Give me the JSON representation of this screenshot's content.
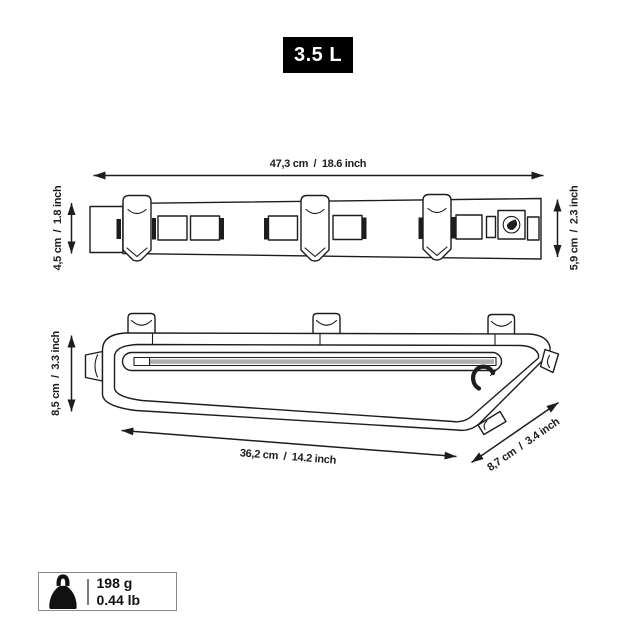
{
  "product_diagram": {
    "badge": {
      "volume_label": "3.5 L"
    },
    "top_view": {
      "width_label": "47,3 cm  /  18.6 inch",
      "height_left_label": "4,5 cm  /  1.8 inch",
      "height_right_label": "5,9 cm  /  2.3 inch"
    },
    "side_view": {
      "height_label": "8,5 cm  /  3.3 inch",
      "length_label": "36,2 cm  /  14.2 inch",
      "depth_label": "8,7 cm  /  3.4 inch"
    },
    "weight": {
      "metric_label": "198 g",
      "imperial_label": "0.44 lb"
    },
    "icons": {
      "weight_icon": "kettlebell-weight",
      "brand_logo_icon": "circular-leaf-logo"
    }
  },
  "colors": {
    "line": "#1d1d1b",
    "badge_bg": "#000000",
    "badge_text": "#ffffff",
    "zipper_gray": "#b0b0b0",
    "weight_box_border": "#8a8a8a",
    "background": "#ffffff"
  }
}
